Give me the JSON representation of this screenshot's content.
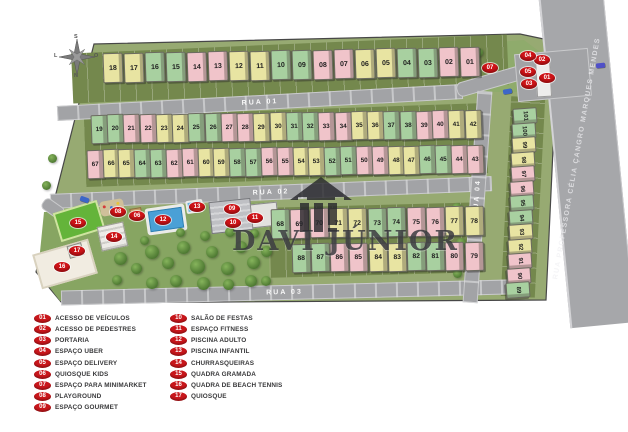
{
  "site": {
    "watermark": {
      "text": "DAVI JÚNIOR"
    },
    "compass": {
      "top": "S",
      "bottom": "N",
      "left": "L",
      "right": "O"
    },
    "streets": {
      "rua01": "RUA 01",
      "rua02": "RUA 02",
      "rua03": "RUA 03",
      "rua04": "RUA 04",
      "outer": "RUA PROFESSORA CÉLIA ÇANGRO MARQUES MENDES"
    },
    "house_rows": {
      "row1": [
        {
          "n": "18",
          "c": "y"
        },
        {
          "n": "17",
          "c": "y"
        },
        {
          "n": "16",
          "c": "g"
        },
        {
          "n": "15",
          "c": "g"
        },
        {
          "n": "14",
          "c": "p"
        },
        {
          "n": "13",
          "c": "p"
        },
        {
          "n": "12",
          "c": "y"
        },
        {
          "n": "11",
          "c": "y"
        },
        {
          "n": "10",
          "c": "g"
        },
        {
          "n": "09",
          "c": "g"
        },
        {
          "n": "08",
          "c": "p"
        },
        {
          "n": "07",
          "c": "p"
        },
        {
          "n": "06",
          "c": "y"
        },
        {
          "n": "05",
          "c": "y"
        },
        {
          "n": "04",
          "c": "g"
        },
        {
          "n": "03",
          "c": "g"
        },
        {
          "n": "02",
          "c": "p"
        },
        {
          "n": "01",
          "c": "p"
        }
      ],
      "row2": [
        {
          "n": "19",
          "c": "g"
        },
        {
          "n": "20",
          "c": "g"
        },
        {
          "n": "21",
          "c": "p"
        },
        {
          "n": "22",
          "c": "p"
        },
        {
          "n": "23",
          "c": "y"
        },
        {
          "n": "24",
          "c": "y"
        },
        {
          "n": "25",
          "c": "g"
        },
        {
          "n": "26",
          "c": "g"
        },
        {
          "n": "27",
          "c": "p"
        },
        {
          "n": "28",
          "c": "p"
        },
        {
          "n": "29",
          "c": "y"
        },
        {
          "n": "30",
          "c": "y"
        },
        {
          "n": "31",
          "c": "g"
        },
        {
          "n": "32",
          "c": "g"
        },
        {
          "n": "33",
          "c": "p"
        },
        {
          "n": "34",
          "c": "p"
        },
        {
          "n": "35",
          "c": "y"
        },
        {
          "n": "36",
          "c": "y"
        },
        {
          "n": "37",
          "c": "g"
        },
        {
          "n": "38",
          "c": "g"
        },
        {
          "n": "39",
          "c": "p"
        },
        {
          "n": "40",
          "c": "p"
        },
        {
          "n": "41",
          "c": "y"
        },
        {
          "n": "42",
          "c": "y"
        }
      ],
      "row3": [
        {
          "n": "67",
          "c": "p"
        },
        {
          "n": "66",
          "c": "y"
        },
        {
          "n": "65",
          "c": "y"
        },
        {
          "n": "64",
          "c": "g"
        },
        {
          "n": "63",
          "c": "g"
        },
        {
          "n": "62",
          "c": "p"
        },
        {
          "n": "61",
          "c": "p"
        },
        {
          "n": "60",
          "c": "y"
        },
        {
          "n": "59",
          "c": "y"
        },
        {
          "n": "58",
          "c": "g"
        },
        {
          "n": "57",
          "c": "g"
        },
        {
          "n": "56",
          "c": "p"
        },
        {
          "n": "55",
          "c": "p"
        },
        {
          "n": "54",
          "c": "y"
        },
        {
          "n": "53",
          "c": "y"
        },
        {
          "n": "52",
          "c": "g"
        },
        {
          "n": "51",
          "c": "g"
        },
        {
          "n": "50",
          "c": "p"
        },
        {
          "n": "49",
          "c": "p"
        },
        {
          "n": "48",
          "c": "y"
        },
        {
          "n": "47",
          "c": "y"
        },
        {
          "n": "46",
          "c": "g"
        },
        {
          "n": "45",
          "c": "g"
        },
        {
          "n": "44",
          "c": "p"
        },
        {
          "n": "43",
          "c": "p"
        }
      ],
      "row4a": [
        {
          "n": "68",
          "c": "g"
        },
        {
          "n": "69",
          "c": "p"
        },
        {
          "n": "70",
          "c": "p"
        },
        {
          "n": "71",
          "c": "y"
        },
        {
          "n": "72",
          "c": "y"
        },
        {
          "n": "73",
          "c": "g"
        },
        {
          "n": "74",
          "c": "g"
        },
        {
          "n": "75",
          "c": "p"
        },
        {
          "n": "76",
          "c": "p"
        },
        {
          "n": "77",
          "c": "y"
        },
        {
          "n": "78",
          "c": "y"
        }
      ],
      "row4b": [
        {
          "n": "88",
          "c": "g"
        },
        {
          "n": "87",
          "c": "g"
        },
        {
          "n": "86",
          "c": "p"
        },
        {
          "n": "85",
          "c": "p"
        },
        {
          "n": "84",
          "c": "y"
        },
        {
          "n": "83",
          "c": "y"
        },
        {
          "n": "82",
          "c": "g"
        },
        {
          "n": "81",
          "c": "g"
        },
        {
          "n": "80",
          "c": "p"
        },
        {
          "n": "79",
          "c": "p"
        }
      ],
      "colR": [
        {
          "n": "101",
          "c": "g"
        },
        {
          "n": "100",
          "c": "g"
        },
        {
          "n": "99",
          "c": "y"
        },
        {
          "n": "98",
          "c": "y"
        },
        {
          "n": "97",
          "c": "p"
        },
        {
          "n": "96",
          "c": "p"
        },
        {
          "n": "95",
          "c": "g"
        },
        {
          "n": "94",
          "c": "g"
        },
        {
          "n": "93",
          "c": "y"
        },
        {
          "n": "92",
          "c": "y"
        },
        {
          "n": "91",
          "c": "p"
        },
        {
          "n": "90",
          "c": "p"
        },
        {
          "n": "89",
          "c": "g"
        }
      ]
    },
    "markers": [
      {
        "num": "01",
        "x": 547,
        "y": 78
      },
      {
        "num": "02",
        "x": 542,
        "y": 60
      },
      {
        "num": "03",
        "x": 529,
        "y": 84
      },
      {
        "num": "04",
        "x": 528,
        "y": 56
      },
      {
        "num": "05",
        "x": 528,
        "y": 72
      },
      {
        "num": "06",
        "x": 137,
        "y": 216
      },
      {
        "num": "07",
        "x": 490,
        "y": 68
      },
      {
        "num": "08",
        "x": 118,
        "y": 212
      },
      {
        "num": "09",
        "x": 232,
        "y": 209
      },
      {
        "num": "10",
        "x": 233,
        "y": 223
      },
      {
        "num": "11",
        "x": 255,
        "y": 218
      },
      {
        "num": "12",
        "x": 163,
        "y": 220
      },
      {
        "num": "13",
        "x": 197,
        "y": 207
      },
      {
        "num": "14",
        "x": 114,
        "y": 237
      },
      {
        "num": "15",
        "x": 78,
        "y": 223
      },
      {
        "num": "16",
        "x": 62,
        "y": 267
      },
      {
        "num": "17",
        "x": 77,
        "y": 251
      }
    ]
  },
  "colors": {
    "house": {
      "y": "#e8e4a2",
      "g": "#a8d0a0",
      "p": "#f0c4ca"
    },
    "marker_red": "#ce1317",
    "grass": "#97aa72",
    "road_gray": "#a2a3a6"
  },
  "legend": {
    "columns": [
      [
        {
          "num": "01",
          "label": "ACESSO DE VEÍCULOS"
        },
        {
          "num": "02",
          "label": "ACESSO DE PEDESTRES"
        },
        {
          "num": "03",
          "label": "PORTARIA"
        },
        {
          "num": "04",
          "label": "ESPAÇO UBER"
        },
        {
          "num": "05",
          "label": "ESPAÇO DELIVERY"
        },
        {
          "num": "06",
          "label": "QUIOSQUE KIDS"
        },
        {
          "num": "07",
          "label": "ESPAÇO PARA MINIMARKET"
        },
        {
          "num": "08",
          "label": "PLAYGROUND"
        },
        {
          "num": "09",
          "label": "ESPAÇO GOURMET"
        }
      ],
      [
        {
          "num": "10",
          "label": "SALÃO DE FESTAS"
        },
        {
          "num": "11",
          "label": "ESPAÇO FITNESS"
        },
        {
          "num": "12",
          "label": "PISCINA ADULTO"
        },
        {
          "num": "13",
          "label": "PISCINA INFANTIL"
        },
        {
          "num": "14",
          "label": "CHURRASQUEIRAS"
        },
        {
          "num": "15",
          "label": "QUADRA GRAMADA"
        },
        {
          "num": "16",
          "label": "QUADRA DE BEACH TENNIS"
        },
        {
          "num": "17",
          "label": "QUIOSQUE"
        }
      ]
    ]
  }
}
